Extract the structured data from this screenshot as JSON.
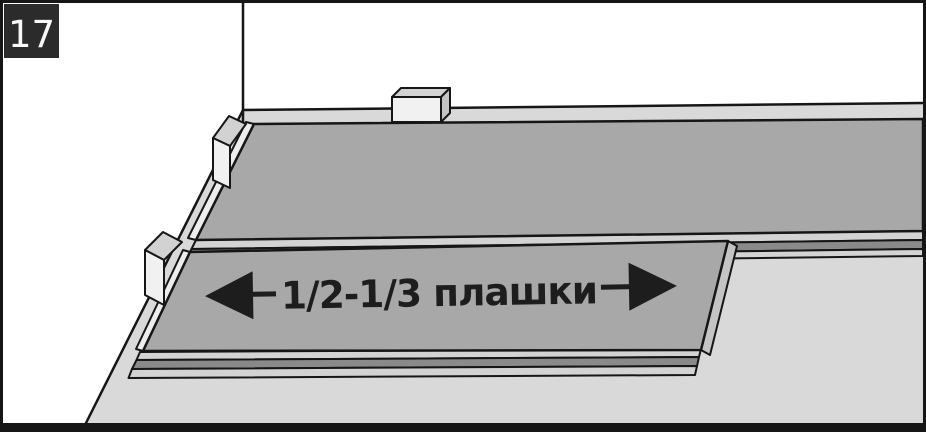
{
  "figure": {
    "step_number": "17",
    "annotation_label": "1/2-1/3 плашки",
    "colors": {
      "wall": "#ffffff",
      "floor": "#d9d9d9",
      "plank_surface": "#a8a8a8",
      "edge_light": "#d3d3d3",
      "edge_dark": "#8a8a8a",
      "end_face": "#ededed",
      "end_face_side": "#c4c4c4",
      "spacer_front": "#f1f1f1",
      "spacer_top": "#d2d2d2",
      "spacer_side": "#c4c4c4",
      "outline": "#161616",
      "ink": "#1d1d1d",
      "badge_bg": "#2b2b2b",
      "badge_text": "#f7f7f7"
    }
  }
}
